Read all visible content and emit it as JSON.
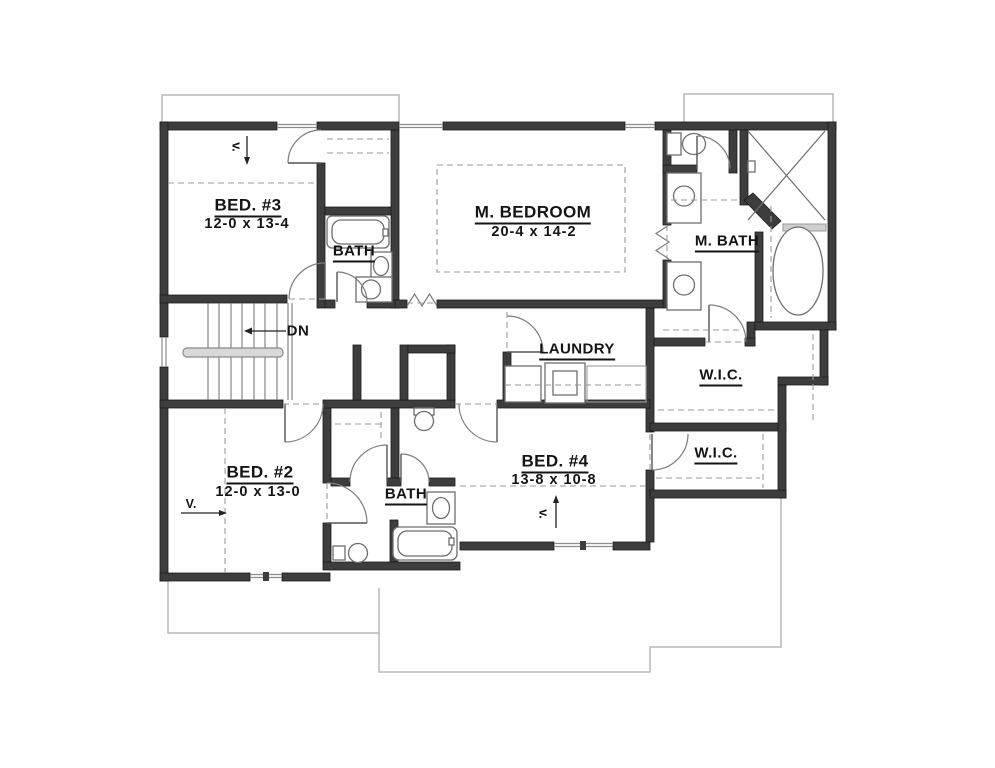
{
  "plan": {
    "type": "floor-plan",
    "rooms": {
      "bed3": {
        "name": "BED. #3",
        "dims": "12-0 x 13-4"
      },
      "bath_upper": {
        "name": "BATH"
      },
      "master_bedroom": {
        "name": "M. BEDROOM",
        "dims": "20-4 x 14-2"
      },
      "master_bath": {
        "name": "M. BATH"
      },
      "laundry": {
        "name": "LAUNDRY"
      },
      "wic_upper": {
        "name": "W.I.C."
      },
      "wic_lower": {
        "name": "W.I.C."
      },
      "bed2": {
        "name": "BED. #2",
        "dims": "12-0 x 13-0"
      },
      "bath_lower": {
        "name": "BATH"
      },
      "bed4": {
        "name": "BED. #4",
        "dims": "13-8 x 10-8"
      }
    },
    "annotations": {
      "stair_direction": "DN",
      "vault_bed3": "v.",
      "vault_bed2": "V.",
      "vault_bed4": "v."
    },
    "colors": {
      "wall": "#3d3d3d",
      "fixture_line": "#6e6e6e",
      "roof_outline": "#b9b9b9",
      "text": "#141414",
      "background": "#ffffff"
    }
  }
}
